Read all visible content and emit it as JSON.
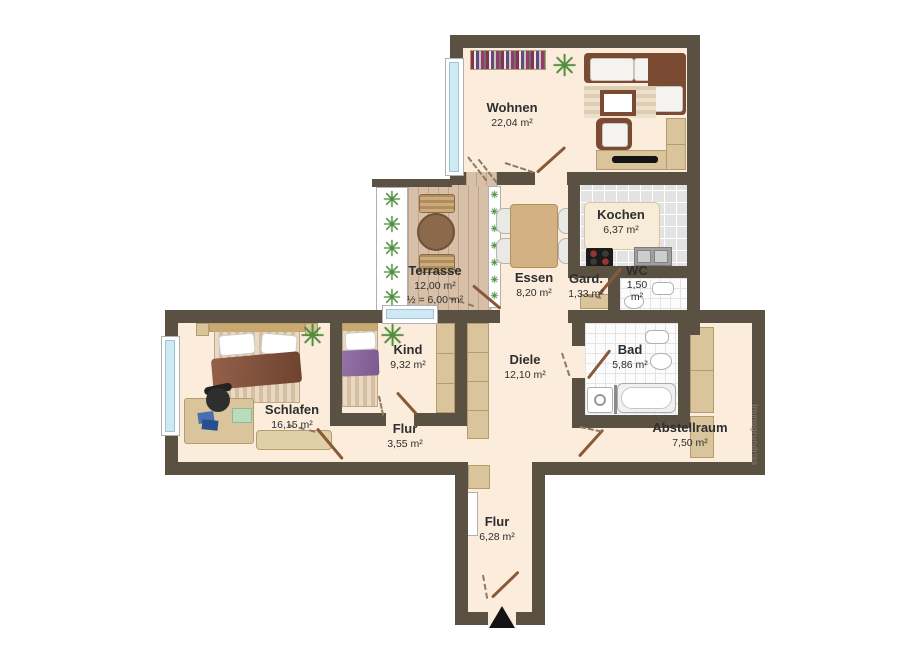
{
  "plan": {
    "watermark": "Immogrundriss",
    "icons": {
      "plant": "✳",
      "entrance_arrow": "up-triangle"
    },
    "colors": {
      "wall": "#5b5143",
      "floor": "#fbecdc",
      "tile": "#e3e3e3",
      "bath_tile": "#fcfcfc",
      "deck": "#d8bfa8",
      "window_glass": "#cfe9f4",
      "furniture_brown": "#7a4a33",
      "furniture_tan": "#d9c49c",
      "plant_green": "#4e8f3a",
      "door_leaf": "#8a5a38",
      "label_text": "#2e2e2e",
      "watermark_text": "#8b7f6d"
    },
    "rooms": [
      {
        "id": "wohnen",
        "name": "Wohnen",
        "area": "22,04 m²"
      },
      {
        "id": "kochen",
        "name": "Kochen",
        "area": "6,37 m²"
      },
      {
        "id": "terrasse",
        "name": "Terrasse",
        "area": "12,00 m²",
        "area2": "½ = 6,00 m²"
      },
      {
        "id": "essen",
        "name": "Essen",
        "area": "8,20 m²"
      },
      {
        "id": "gard",
        "name": "Gard.",
        "area": "1,33 m²"
      },
      {
        "id": "wc",
        "name": "WC",
        "area": "1,50 m²"
      },
      {
        "id": "bad",
        "name": "Bad",
        "area": "5,86 m²"
      },
      {
        "id": "kind",
        "name": "Kind",
        "area": "9,32 m²"
      },
      {
        "id": "diele",
        "name": "Diele",
        "area": "12,10 m²"
      },
      {
        "id": "schlafen",
        "name": "Schlafen",
        "area": "16,15 m²"
      },
      {
        "id": "flur",
        "name": "Flur",
        "area": "3,55 m²"
      },
      {
        "id": "abstellraum",
        "name": "Abstellraum",
        "area": "7,50 m²"
      },
      {
        "id": "flur_eingang",
        "name": "Flur",
        "area": "6,28 m²"
      }
    ]
  }
}
